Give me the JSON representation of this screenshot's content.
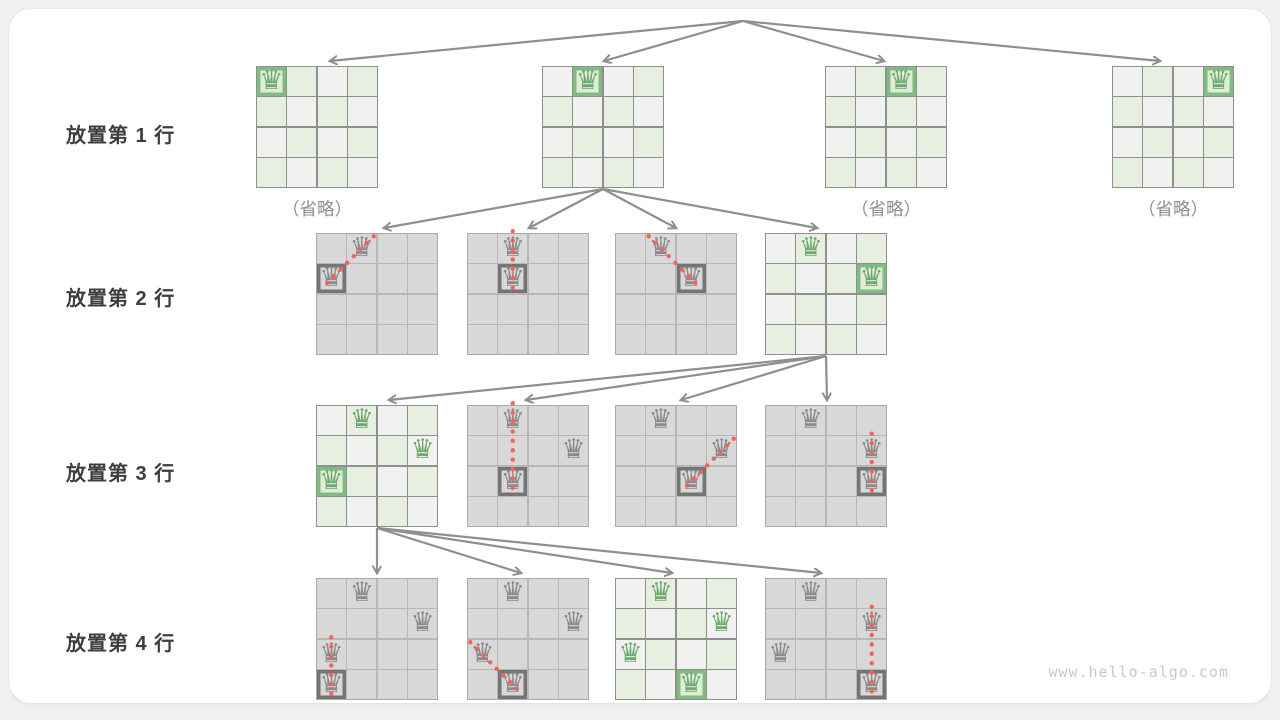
{
  "page": {
    "watermark": "www.hello-algo.com"
  },
  "glyphs": {
    "queen": "♛"
  },
  "colors": {
    "valid_green": "#6fa96f",
    "valid_green_border": "#82bb82",
    "light_green_cell": "#e6efe0",
    "pruned_gray": "#8a8a8a",
    "pruned_cell": "#d8d8d8",
    "attack_red": "#f5635c",
    "arrow_gray": "#8f8f8f"
  },
  "rows": [
    {
      "label": "放置第 1 行"
    },
    {
      "label": "放置第 2 行"
    },
    {
      "label": "放置第 3 行"
    },
    {
      "label": "放置第 4 行"
    }
  ],
  "tree": {
    "boards": [
      {
        "id": "r1b1",
        "level": 1,
        "slot": 0,
        "theme": "green",
        "caption": "（省略）",
        "queens": [
          {
            "r": 0,
            "c": 0,
            "new": true
          }
        ]
      },
      {
        "id": "r1b2",
        "level": 1,
        "slot": 1,
        "theme": "green",
        "queens": [
          {
            "r": 0,
            "c": 1,
            "new": true
          }
        ]
      },
      {
        "id": "r1b3",
        "level": 1,
        "slot": 2,
        "theme": "green",
        "caption": "（省略）",
        "queens": [
          {
            "r": 0,
            "c": 2,
            "new": true
          }
        ]
      },
      {
        "id": "r1b4",
        "level": 1,
        "slot": 3,
        "theme": "green",
        "caption": "（省略）",
        "queens": [
          {
            "r": 0,
            "c": 3,
            "new": true
          }
        ]
      },
      {
        "id": "r2b1",
        "level": 2,
        "slot": 0,
        "theme": "gray",
        "queens": [
          {
            "r": 0,
            "c": 1
          },
          {
            "r": 1,
            "c": 0,
            "new": true
          }
        ],
        "attack": {
          "from": [
            0,
            1
          ],
          "to": [
            1,
            0
          ]
        }
      },
      {
        "id": "r2b2",
        "level": 2,
        "slot": 1,
        "theme": "gray",
        "queens": [
          {
            "r": 0,
            "c": 1
          },
          {
            "r": 1,
            "c": 1,
            "new": true
          }
        ],
        "attack": {
          "from": [
            0,
            1
          ],
          "to": [
            1,
            1
          ]
        }
      },
      {
        "id": "r2b3",
        "level": 2,
        "slot": 2,
        "theme": "gray",
        "queens": [
          {
            "r": 0,
            "c": 1
          },
          {
            "r": 1,
            "c": 2,
            "new": true
          }
        ],
        "attack": {
          "from": [
            0,
            1
          ],
          "to": [
            1,
            2
          ]
        }
      },
      {
        "id": "r2b4",
        "level": 2,
        "slot": 3,
        "theme": "green",
        "queens": [
          {
            "r": 0,
            "c": 1
          },
          {
            "r": 1,
            "c": 3,
            "new": true
          }
        ]
      },
      {
        "id": "r3b1",
        "level": 3,
        "slot": 0,
        "theme": "green",
        "queens": [
          {
            "r": 0,
            "c": 1
          },
          {
            "r": 1,
            "c": 3
          },
          {
            "r": 2,
            "c": 0,
            "new": true
          }
        ]
      },
      {
        "id": "r3b2",
        "level": 3,
        "slot": 1,
        "theme": "gray",
        "queens": [
          {
            "r": 0,
            "c": 1
          },
          {
            "r": 1,
            "c": 3
          },
          {
            "r": 2,
            "c": 1,
            "new": true
          }
        ],
        "attack": {
          "from": [
            0,
            1
          ],
          "to": [
            2,
            1
          ]
        }
      },
      {
        "id": "r3b3",
        "level": 3,
        "slot": 2,
        "theme": "gray",
        "queens": [
          {
            "r": 0,
            "c": 1
          },
          {
            "r": 1,
            "c": 3
          },
          {
            "r": 2,
            "c": 2,
            "new": true
          }
        ],
        "attack": {
          "from": [
            1,
            3
          ],
          "to": [
            2,
            2
          ]
        }
      },
      {
        "id": "r3b4",
        "level": 3,
        "slot": 3,
        "theme": "gray",
        "queens": [
          {
            "r": 0,
            "c": 1
          },
          {
            "r": 1,
            "c": 3
          },
          {
            "r": 2,
            "c": 3,
            "new": true
          }
        ],
        "attack": {
          "from": [
            1,
            3
          ],
          "to": [
            2,
            3
          ]
        }
      },
      {
        "id": "r4b1",
        "level": 4,
        "slot": 0,
        "theme": "gray",
        "queens": [
          {
            "r": 0,
            "c": 1
          },
          {
            "r": 1,
            "c": 3
          },
          {
            "r": 2,
            "c": 0
          },
          {
            "r": 3,
            "c": 0,
            "new": true
          }
        ],
        "attack": {
          "from": [
            2,
            0
          ],
          "to": [
            3,
            0
          ]
        }
      },
      {
        "id": "r4b2",
        "level": 4,
        "slot": 1,
        "theme": "gray",
        "queens": [
          {
            "r": 0,
            "c": 1
          },
          {
            "r": 1,
            "c": 3
          },
          {
            "r": 2,
            "c": 0
          },
          {
            "r": 3,
            "c": 1,
            "new": true
          }
        ],
        "attack": {
          "from": [
            2,
            0
          ],
          "to": [
            3,
            1
          ]
        }
      },
      {
        "id": "r4b3",
        "level": 4,
        "slot": 2,
        "theme": "green",
        "queens": [
          {
            "r": 0,
            "c": 1
          },
          {
            "r": 1,
            "c": 3
          },
          {
            "r": 2,
            "c": 0
          },
          {
            "r": 3,
            "c": 2,
            "new": true
          }
        ]
      },
      {
        "id": "r4b4",
        "level": 4,
        "slot": 3,
        "theme": "gray",
        "queens": [
          {
            "r": 0,
            "c": 1
          },
          {
            "r": 1,
            "c": 3
          },
          {
            "r": 2,
            "c": 0
          },
          {
            "r": 3,
            "c": 3,
            "new": true
          }
        ],
        "attack": {
          "from": [
            1,
            3
          ],
          "to": [
            3,
            3
          ]
        }
      }
    ],
    "edges": [
      {
        "from": "root",
        "to": "r1b1"
      },
      {
        "from": "root",
        "to": "r1b2"
      },
      {
        "from": "root",
        "to": "r1b3"
      },
      {
        "from": "root",
        "to": "r1b4"
      },
      {
        "from": "r1b2",
        "to": "r2b1"
      },
      {
        "from": "r1b2",
        "to": "r2b2"
      },
      {
        "from": "r1b2",
        "to": "r2b3"
      },
      {
        "from": "r1b2",
        "to": "r2b4"
      },
      {
        "from": "r2b4",
        "to": "r3b1"
      },
      {
        "from": "r2b4",
        "to": "r3b2"
      },
      {
        "from": "r2b4",
        "to": "r3b3"
      },
      {
        "from": "r2b4",
        "to": "r3b4"
      },
      {
        "from": "r3b1",
        "to": "r4b1"
      },
      {
        "from": "r3b1",
        "to": "r4b2"
      },
      {
        "from": "r3b1",
        "to": "r4b3"
      },
      {
        "from": "r3b1",
        "to": "r4b4"
      }
    ]
  }
}
